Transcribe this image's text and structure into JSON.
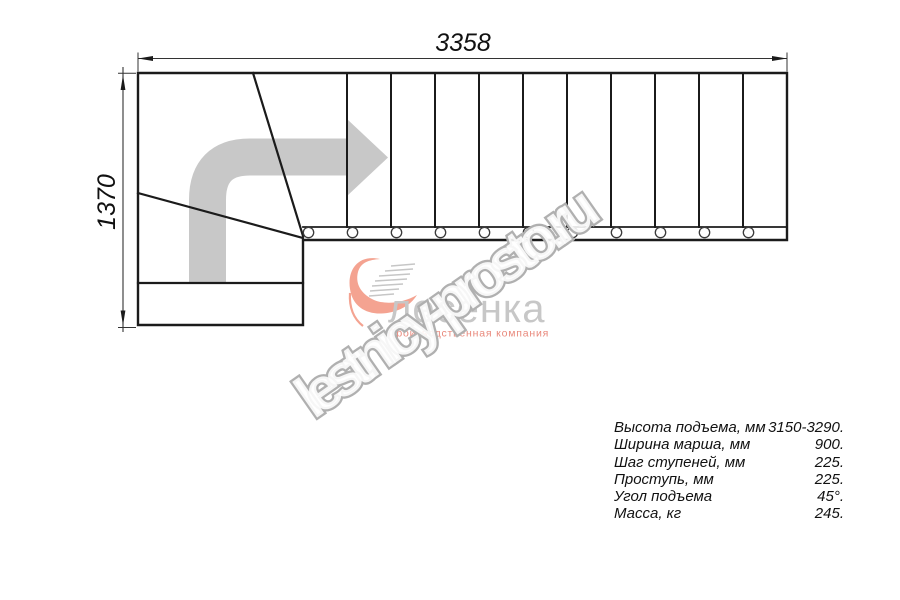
{
  "dimensions": {
    "width_mm": "3358",
    "height_mm": "1370"
  },
  "specs": [
    {
      "label": "Высота подъема, мм",
      "value": "3150-3290."
    },
    {
      "label": "Ширина марша, мм",
      "value": "900."
    },
    {
      "label": "Шаг ступеней, мм",
      "value": "225."
    },
    {
      "label": "Проступь, мм",
      "value": "225."
    },
    {
      "label": "Угол подъема",
      "value": "45°."
    },
    {
      "label": "Масса, кг",
      "value": "245."
    }
  ],
  "logo": {
    "brand": "лесенка",
    "tagline": "Производственная компания"
  },
  "watermark": {
    "text": "lestnicy-prosto.ru"
  },
  "colors": {
    "drawing_line": "#1b1b1b",
    "direction_arrow": "#c8c8c8",
    "watermark_outline": "#b0b0b0",
    "logo_salmon": "#f4a391",
    "logo_brand_gray": "#c7c7c7",
    "logo_tagline": "#e9897c"
  }
}
